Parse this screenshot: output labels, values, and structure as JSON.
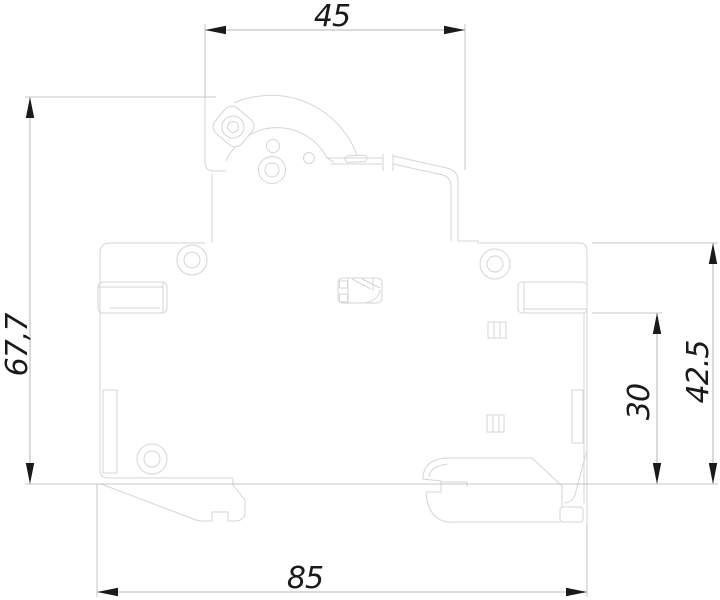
{
  "drawing": {
    "type": "technical-dimension-drawing",
    "subject": "circuit-breaker-side-profile",
    "dimensions": {
      "top_width": {
        "label": "45"
      },
      "left_height": {
        "label": "67,7"
      },
      "right_height": {
        "label": "42.5"
      },
      "right_inner_height": {
        "label": "30"
      },
      "bottom_width": {
        "label": "85"
      }
    },
    "colors": {
      "background": "#ffffff",
      "outline": "#d5d5d5",
      "dimension_line": "#b5b5b5",
      "arrow": "#1a1a1a",
      "dimension_text": "#1a1a1a"
    }
  }
}
